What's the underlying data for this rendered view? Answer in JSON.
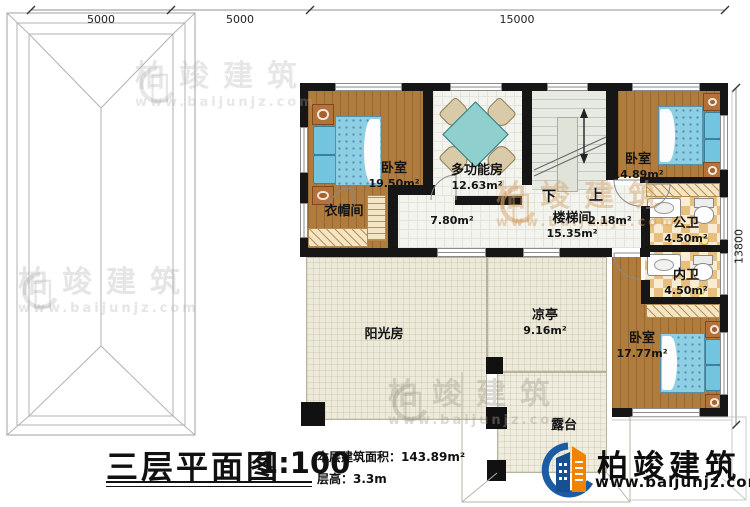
{
  "dims": {
    "top": [
      "5000",
      "5000",
      "15000"
    ],
    "right": "13800"
  },
  "rooms": {
    "bedroom_tl": {
      "name": "卧室",
      "area": "19.50m²"
    },
    "multifunction": {
      "name": "多功能房",
      "area": "12.63m²"
    },
    "bedroom_tr": {
      "name": "卧室",
      "area": "14.89m²"
    },
    "cloakroom": {
      "name": "衣帽间"
    },
    "stairwell": {
      "name": "楼梯间",
      "area": "15.35m²"
    },
    "corridor": {
      "area": "7.80m²"
    },
    "landing": {
      "area": "2.18m²"
    },
    "public_bath": {
      "name": "公卫",
      "area": "4.50m²"
    },
    "inner_bath": {
      "name": "内卫",
      "area": "4.50m²"
    },
    "bedroom_br": {
      "name": "卧室",
      "area": "17.77m²"
    },
    "sunroom": {
      "name": "阳光房"
    },
    "pavilion": {
      "name": "凉亭",
      "area": "9.16m²"
    },
    "terrace": {
      "name": "露台"
    }
  },
  "stairs": {
    "down": "下",
    "up": "上"
  },
  "title_block": {
    "title": "三层平面图",
    "scale": "1:100",
    "area_label": "本层建筑面积：",
    "area_value": "143.89m²",
    "floor_height_label": "层高：",
    "floor_height_value": "3.3m"
  },
  "brand": {
    "name": "柏竣建筑",
    "url": "www.baijunjz.com",
    "blue": "#1b5ca4",
    "orange": "#f08300"
  },
  "watermark": {
    "name": "柏竣建筑",
    "url": "www.baijunjz.com"
  },
  "colors": {
    "wall": "#161616",
    "wood_floor": "#b07c3e",
    "bed": "#8ecfe4",
    "tile": "#f4f4ef",
    "bath_tile": "#e7c080",
    "sunroom_floor": "#edead9"
  }
}
